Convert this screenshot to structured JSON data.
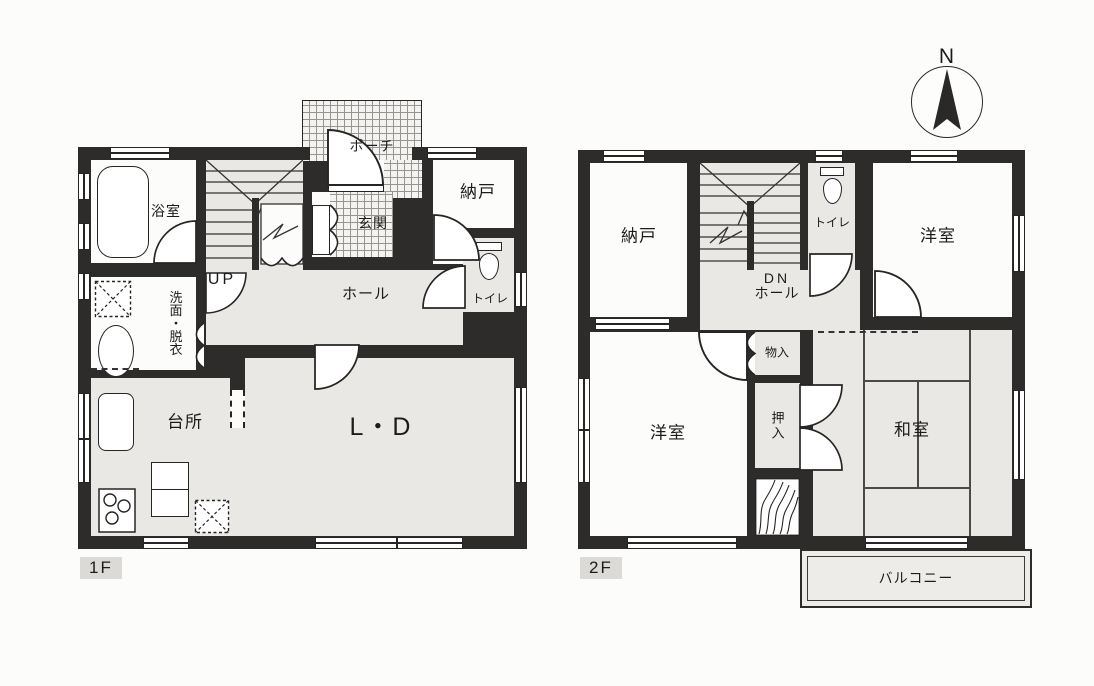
{
  "compass": {
    "north_label": "N"
  },
  "floor1": {
    "floor_label": "1F",
    "rooms": {
      "porch": "ポーチ",
      "entrance": "玄関",
      "bathroom": "浴室",
      "washroom": "洗面・脱衣",
      "stairs": "UP",
      "hall": "ホール",
      "storage": "納戸",
      "toilet": "トイレ",
      "kitchen": "台所",
      "living_dining": "L・D"
    }
  },
  "floor2": {
    "floor_label": "2F",
    "rooms": {
      "storage": "納戸",
      "stairs": "DN",
      "hall": "ホール",
      "toilet": "トイレ",
      "western_room_ne": "洋室",
      "western_room_sw": "洋室",
      "small_storage": "物入",
      "futon_closet": "押入",
      "japanese_room": "和室",
      "balcony": "バルコニー"
    }
  },
  "colors": {
    "wall": "#2e2c2b",
    "room_gray": "#e9e8e4",
    "room_white": "#fcfcfb",
    "line": "#262524"
  }
}
